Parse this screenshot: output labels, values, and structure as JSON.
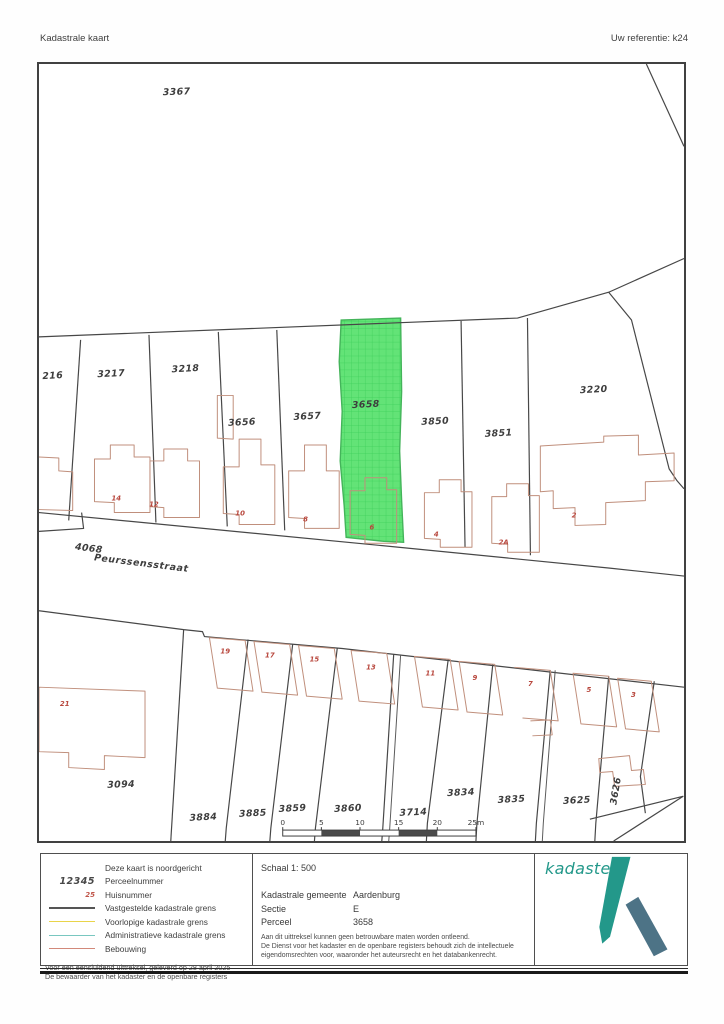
{
  "header": {
    "title": "Kadastrale kaart",
    "reference": "Uw referentie: k24"
  },
  "map": {
    "highlight_parcel": "3658",
    "street": {
      "name": "Peurssensstraat",
      "x": 103,
      "y": 506,
      "rot": 7
    },
    "parcel_labels": [
      {
        "label": "3367",
        "x": 139,
        "y": 31,
        "rot": -2
      },
      {
        "label": "216",
        "x": 14,
        "y": 317,
        "rot": -3
      },
      {
        "label": "3217",
        "x": 73,
        "y": 315,
        "rot": -3
      },
      {
        "label": "3218",
        "x": 148,
        "y": 310,
        "rot": -3
      },
      {
        "label": "3656",
        "x": 205,
        "y": 364,
        "rot": -3
      },
      {
        "label": "3657",
        "x": 271,
        "y": 358,
        "rot": -3
      },
      {
        "label": "3658",
        "x": 330,
        "y": 346,
        "rot": -3
      },
      {
        "label": "3850",
        "x": 400,
        "y": 363,
        "rot": -3
      },
      {
        "label": "3851",
        "x": 464,
        "y": 375,
        "rot": -3
      },
      {
        "label": "3220",
        "x": 560,
        "y": 331,
        "rot": -3
      },
      {
        "label": "4068",
        "x": 50,
        "y": 491,
        "rot": 7
      },
      {
        "label": "3094",
        "x": 83,
        "y": 729,
        "rot": -2
      },
      {
        "label": "3884",
        "x": 166,
        "y": 762,
        "rot": -3
      },
      {
        "label": "3885",
        "x": 216,
        "y": 758,
        "rot": -3
      },
      {
        "label": "3859",
        "x": 256,
        "y": 753,
        "rot": -3
      },
      {
        "label": "3860",
        "x": 312,
        "y": 753,
        "rot": -3
      },
      {
        "label": "3714",
        "x": 378,
        "y": 757,
        "rot": -3
      },
      {
        "label": "3834",
        "x": 426,
        "y": 737,
        "rot": -3
      },
      {
        "label": "3835",
        "x": 477,
        "y": 744,
        "rot": -3
      },
      {
        "label": "3625",
        "x": 543,
        "y": 745,
        "rot": -3
      },
      {
        "label": "3626",
        "x": 585,
        "y": 733,
        "rot": -80
      }
    ],
    "house_numbers": [
      {
        "label": "14",
        "x": 78,
        "y": 440
      },
      {
        "label": "12",
        "x": 116,
        "y": 446
      },
      {
        "label": "10",
        "x": 203,
        "y": 455
      },
      {
        "label": "8",
        "x": 269,
        "y": 461
      },
      {
        "label": "6",
        "x": 336,
        "y": 469
      },
      {
        "label": "4",
        "x": 401,
        "y": 476
      },
      {
        "label": "2A",
        "x": 469,
        "y": 484
      },
      {
        "label": "2",
        "x": 540,
        "y": 457
      },
      {
        "label": "21",
        "x": 26,
        "y": 647
      },
      {
        "label": "19",
        "x": 188,
        "y": 594
      },
      {
        "label": "17",
        "x": 233,
        "y": 598
      },
      {
        "label": "15",
        "x": 278,
        "y": 602
      },
      {
        "label": "13",
        "x": 335,
        "y": 610
      },
      {
        "label": "11",
        "x": 395,
        "y": 616
      },
      {
        "label": "9",
        "x": 440,
        "y": 621
      },
      {
        "label": "7",
        "x": 496,
        "y": 627
      },
      {
        "label": "5",
        "x": 555,
        "y": 633
      },
      {
        "label": "3",
        "x": 600,
        "y": 638
      }
    ],
    "scalebar": {
      "ticks": [
        "0",
        "5",
        "10",
        "15",
        "20",
        "25m"
      ]
    }
  },
  "legend": {
    "items": [
      {
        "symbol_type": "none",
        "symbol": "",
        "label": "Deze kaart is noordgericht"
      },
      {
        "symbol_type": "text",
        "symbol": "12345",
        "label": "Perceelnummer"
      },
      {
        "symbol_type": "text-red",
        "symbol": "25",
        "label": "Huisnummer"
      },
      {
        "symbol_type": "line",
        "color": "#555555",
        "weight": 2.5,
        "label": "Vastgestelde kadastrale grens"
      },
      {
        "symbol_type": "line",
        "color": "#e9d44a",
        "weight": 1.5,
        "label": "Voorlopige kadastrale grens"
      },
      {
        "symbol_type": "line",
        "color": "#79c7c0",
        "weight": 1.5,
        "label": "Administratieve kadastrale grens"
      },
      {
        "symbol_type": "line",
        "color": "#d2897a",
        "weight": 1.2,
        "label": "Bebouwing"
      }
    ]
  },
  "info": {
    "schaal": "Schaal 1: 500",
    "rows": [
      {
        "label": "Kadastrale gemeente",
        "value": "Aardenburg"
      },
      {
        "label": "Sectie",
        "value": "E"
      },
      {
        "label": "Perceel",
        "value": "3658"
      }
    ]
  },
  "footer_left": [
    "Voor een eensluidend uittreksel, geleverd op 28 april 2025",
    "De bewaarder van het kadaster en de openbare registers"
  ],
  "footer_right": [
    "Aan dit uittreksel kunnen geen betrouwbare maten worden ontleend.",
    "De Dienst voor het kadaster en de openbare registers behoudt zich de intellectuele",
    "eigendomsrechten voor, waaronder het auteursrecht en het databankenrecht."
  ],
  "logo": {
    "text": "kadaster"
  },
  "colors": {
    "highlight_green": "#63e377",
    "boundary": "#474747",
    "building": "#c08f7c",
    "house_number": "#b8473d",
    "logo_teal": "#23988a",
    "logo_slate": "#4d7386"
  }
}
